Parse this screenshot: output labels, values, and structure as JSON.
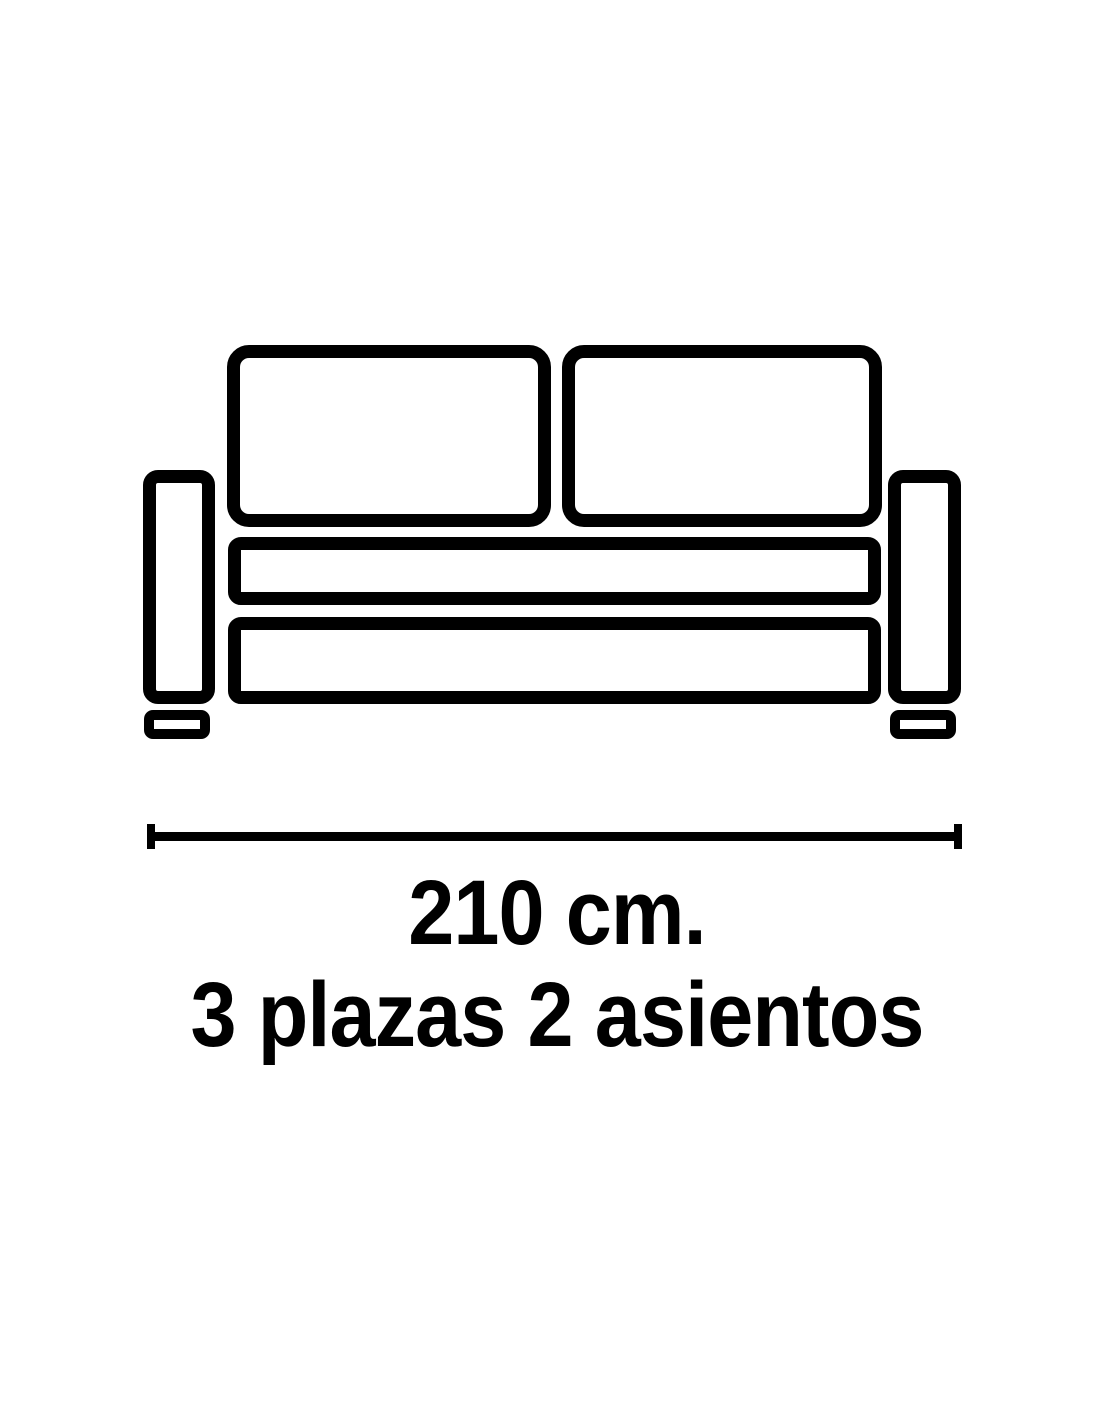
{
  "colors": {
    "ink": "#000000",
    "background": "#ffffff"
  },
  "diagram": {
    "type": "sofa-front-outline-pictogram",
    "parts": [
      "back-cushion-left",
      "back-cushion-right",
      "armrest-left",
      "armrest-right",
      "seat-back-rail",
      "seat-base",
      "foot-left",
      "foot-right"
    ]
  },
  "dimension": {
    "label": "210 cm.",
    "value_cm": 210
  },
  "caption": {
    "line1": "210 cm.",
    "line2": "3 plazas 2 asientos"
  }
}
